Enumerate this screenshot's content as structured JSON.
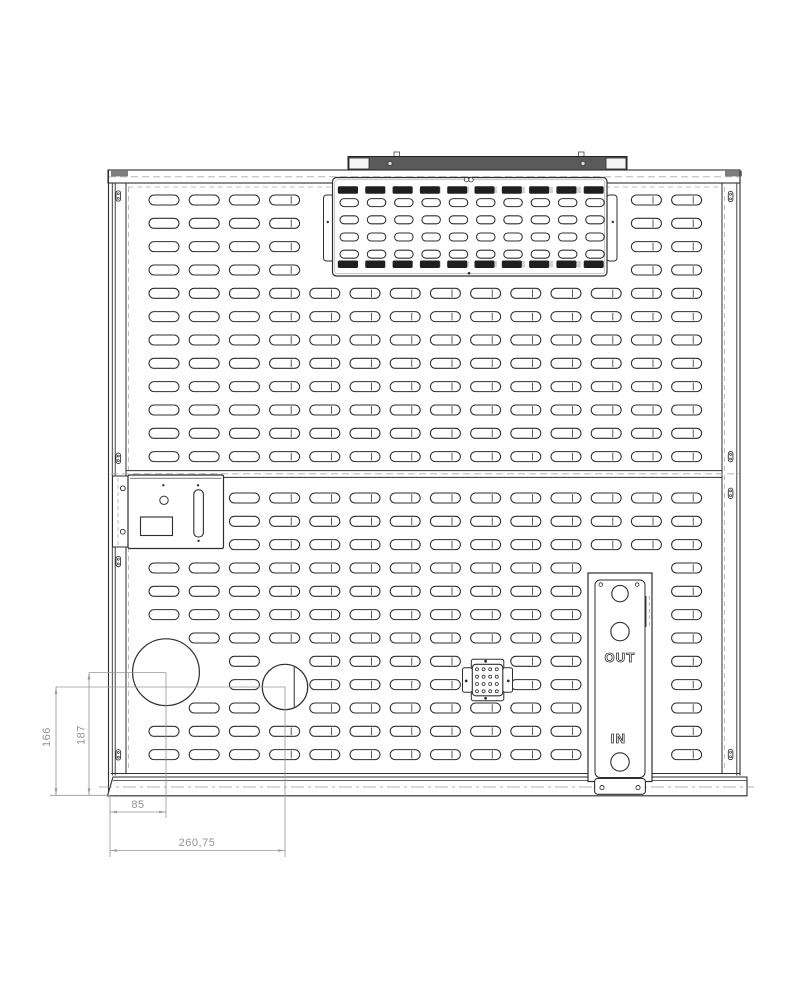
{
  "drawing": {
    "title": "perforated-cabinet-rear-panel-drawing",
    "line_color": "#2e2e2e",
    "light_line_color": "#b0b0b0",
    "dim_color": "#999999",
    "dark_slot_color": "#1f1f1f",
    "rail_fill": "#5a5a5a",
    "wedge_fill": "#7d7d7d"
  },
  "dimensions": {
    "vertical": [
      {
        "label": "166"
      },
      {
        "label": "187"
      }
    ],
    "horizontal": [
      {
        "label": "85"
      },
      {
        "label": "260,75"
      }
    ]
  },
  "ports": {
    "out_label": "OUT",
    "in_label": "IN"
  },
  "grids": {
    "upper": {
      "origin_x": 149,
      "first_row_y": 200,
      "pitch_x": 40.2,
      "pitch_y": 23.33,
      "cols": 14,
      "rows": 12,
      "slot_w": 30,
      "slot_h": 10,
      "rect_keepouts": [
        [
          322,
          174,
          618,
          280
        ]
      ],
      "circle_keepouts": []
    },
    "lower": {
      "origin_x": 149,
      "first_row_y": 498,
      "pitch_x": 40.2,
      "pitch_y": 23.33,
      "cols": 14,
      "rows": 12,
      "slot_w": 30,
      "slot_h": 10,
      "rect_keepouts": [
        [
          127,
          474,
          224,
          549
        ],
        [
          464,
          660,
          509,
          700
        ],
        [
          587,
          560,
          653,
          782
        ]
      ],
      "circle_keepouts": [
        [
          166,
          672.2,
          33.4
        ],
        [
          285,
          687,
          22.7
        ]
      ]
    },
    "inset_open": {
      "origin_x": 340,
      "first_row_y": 202.6,
      "pitch_x": 27.3,
      "pitch_y": 17.2,
      "cols": 10,
      "rows": 4,
      "slot_w": 18.5,
      "slot_h": 8,
      "rect_keepouts": [],
      "circle_keepouts": []
    },
    "inset_dark": {
      "origin_x": 338,
      "rows_y": [
        190,
        264.2
      ],
      "pitch_x": 27.3,
      "cols": 10,
      "slot_w": 20,
      "slot_h": 7.5
    }
  },
  "holes": {
    "large": {
      "cx": 166,
      "cy": 672.2,
      "r": 33.4
    },
    "small": {
      "cx": 285,
      "cy": 687,
      "r": 22.7,
      "chord_x": 294.2,
      "chord_y1": 666.5,
      "chord_y2": 707.5
    },
    "dot_grid": {
      "xs": [
        477,
        483.6,
        490.2,
        496.8
      ],
      "ys": [
        669.3,
        676.7,
        684,
        691.3
      ],
      "r": 1.5
    }
  }
}
